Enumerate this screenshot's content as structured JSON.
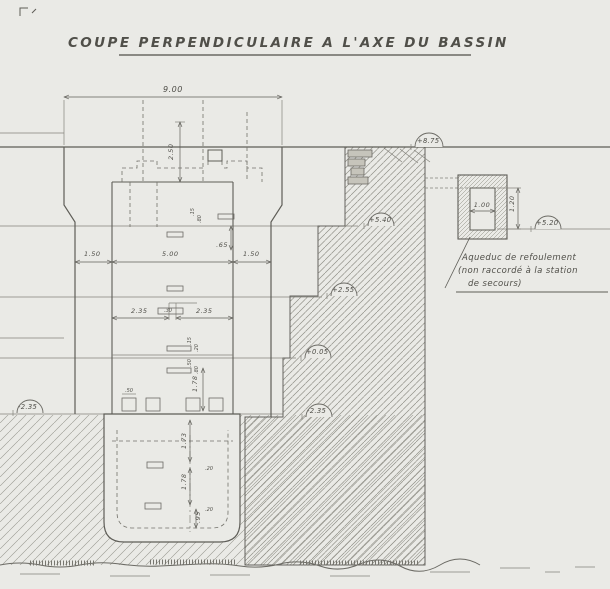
{
  "title": "COUPE PERPENDICULAIRE A L'AXE DU BASSIN",
  "dims": {
    "d900": "9.00",
    "d150": "1.50",
    "d500": "5.00",
    "d235": "2.35",
    "d30": ".30",
    "d250": "2.50",
    "d65": ".65",
    "d173": "1.73",
    "d178": "1.78",
    "d95": ".95"
  },
  "tiny": {
    "t15": ".15",
    "t80": ".80",
    "t50": ".50",
    "t20": ".20"
  },
  "levels": {
    "l875": "+8.75",
    "l540": "+5.40",
    "l255": "+2.55",
    "l005": "+0.05",
    "l235": "-2.35",
    "l520": "+5.20"
  },
  "aqueduct": {
    "width": "1.00",
    "height": "1.20",
    "caption1": "Aqueduc de refoulement",
    "caption2": "(non raccordé à la station",
    "caption3": "de secours)"
  }
}
